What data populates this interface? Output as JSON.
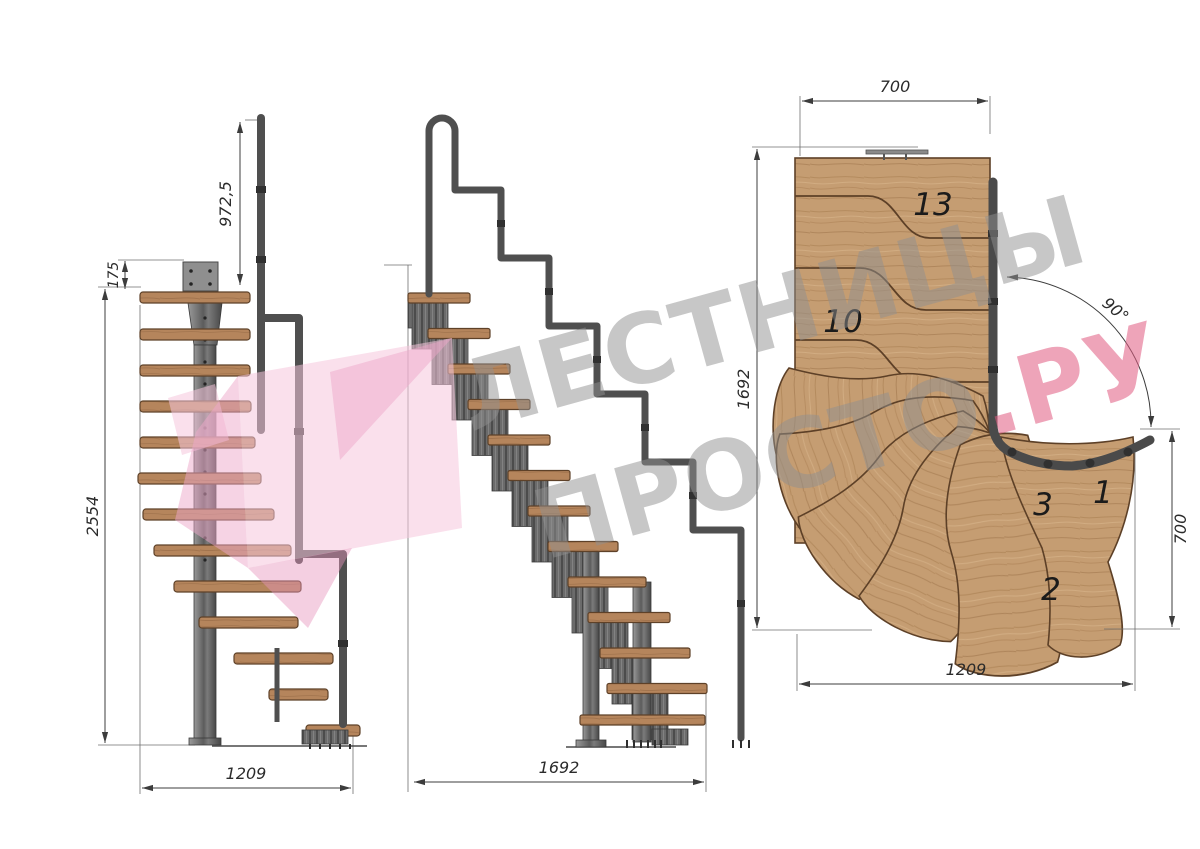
{
  "drawing": {
    "front_view": {
      "dim_rail_height": "972,5",
      "dim_landing": "175",
      "dim_total_height": "2554",
      "dim_width": "1209"
    },
    "side_view": {
      "dim_length": "1692"
    },
    "plan_view": {
      "dim_top_width": "700",
      "dim_height": "1692",
      "dim_turn_angle": "90°",
      "dim_right_width": "700",
      "dim_bottom_width": "1209",
      "step_labels": {
        "top": "13",
        "middle": "10",
        "third": "3",
        "first": "1",
        "second": "2"
      }
    },
    "watermark": {
      "line1": "ЛЕСТНИЦЫ",
      "line2": "ПРОСТО",
      "line2_suffix": ".РУ"
    },
    "colors": {
      "wood_plan": "#c59d72",
      "wood_elevation": "#b5855c",
      "steel": "#6b6b6b",
      "steel_dark": "#3f3f3f",
      "dimension": "#3c3c3c",
      "watermark_gray": "#8f8f8f",
      "watermark_pink": "#e05a80",
      "logo_pink_light": "#f5c6dc",
      "logo_pink_mid": "#eda7c9"
    }
  }
}
